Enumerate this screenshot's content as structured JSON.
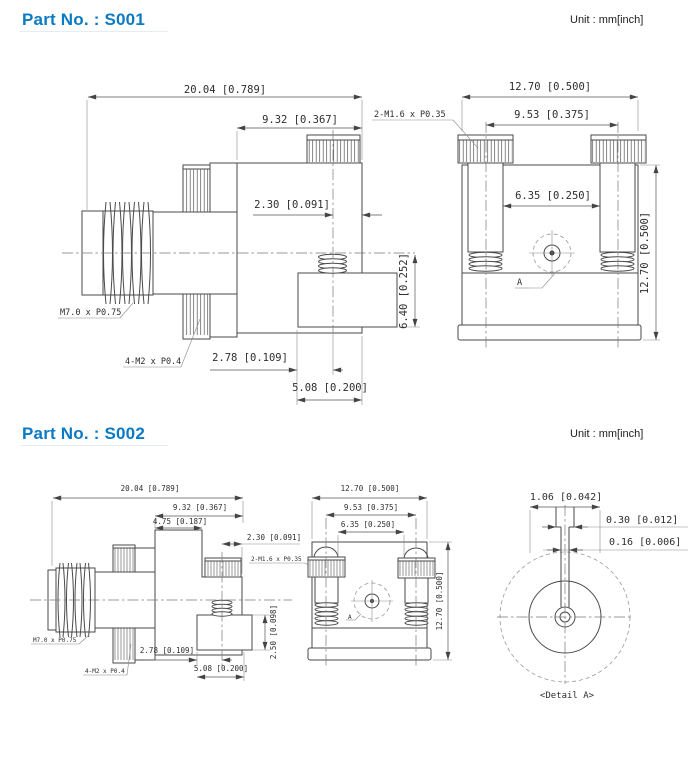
{
  "s001": {
    "title": "Part No. : S001",
    "unit": "Unit : mm[inch]",
    "side": {
      "dim_overall_width": "20.04 [0.789]",
      "dim_body_width": "9.32 [0.367]",
      "dim_screw_offset": "2.30 [0.091]",
      "dim_stud_height": "6.40 [0.252]",
      "dim_stud_offset": "2.78 [0.109]",
      "dim_stud_width": "5.08 [0.200]",
      "label_thread": "M7.0 x P0.75",
      "label_nut_thread": "4-M2 x P0.4"
    },
    "front": {
      "label_screw_thread": "2-M1.6 x P0.35",
      "dim_overall_width": "12.70 [0.500]",
      "dim_screw_spacing": "9.53 [0.375]",
      "dim_inner_spacing": "6.35 [0.250]",
      "dim_overall_height": "12.70 [0.500]",
      "label_detail": "A"
    }
  },
  "s002": {
    "title": "Part No. : S002",
    "unit": "Unit : mm[inch]",
    "side": {
      "dim_overall_width": "20.04 [0.789]",
      "dim_body_width": "9.32 [0.367]",
      "dim_step_width": "4.75 [0.187]",
      "dim_screw_offset": "2.30 [0.091]",
      "dim_stud_height": "2.50 [0.098]",
      "dim_stud_offset": "2.78 [0.109]",
      "dim_stud_width": "5.08 [0.200]",
      "label_thread": "M7.0 x P0.75",
      "label_nut_thread": "4-M2 x P0.4",
      "label_screw_thread": "2-M1.6 x P0.35"
    },
    "front": {
      "dim_overall_width": "12.70 [0.500]",
      "dim_screw_spacing": "9.53 [0.375]",
      "dim_inner_spacing": "6.35 [0.250]",
      "dim_overall_height": "12.70 [0.500]",
      "label_detail": "A"
    },
    "detail": {
      "dim_outer": "1.06 [0.042]",
      "dim_pin": "0.30 [0.012]",
      "dim_center": "0.16 [0.006]",
      "caption": "<Detail A>"
    }
  }
}
